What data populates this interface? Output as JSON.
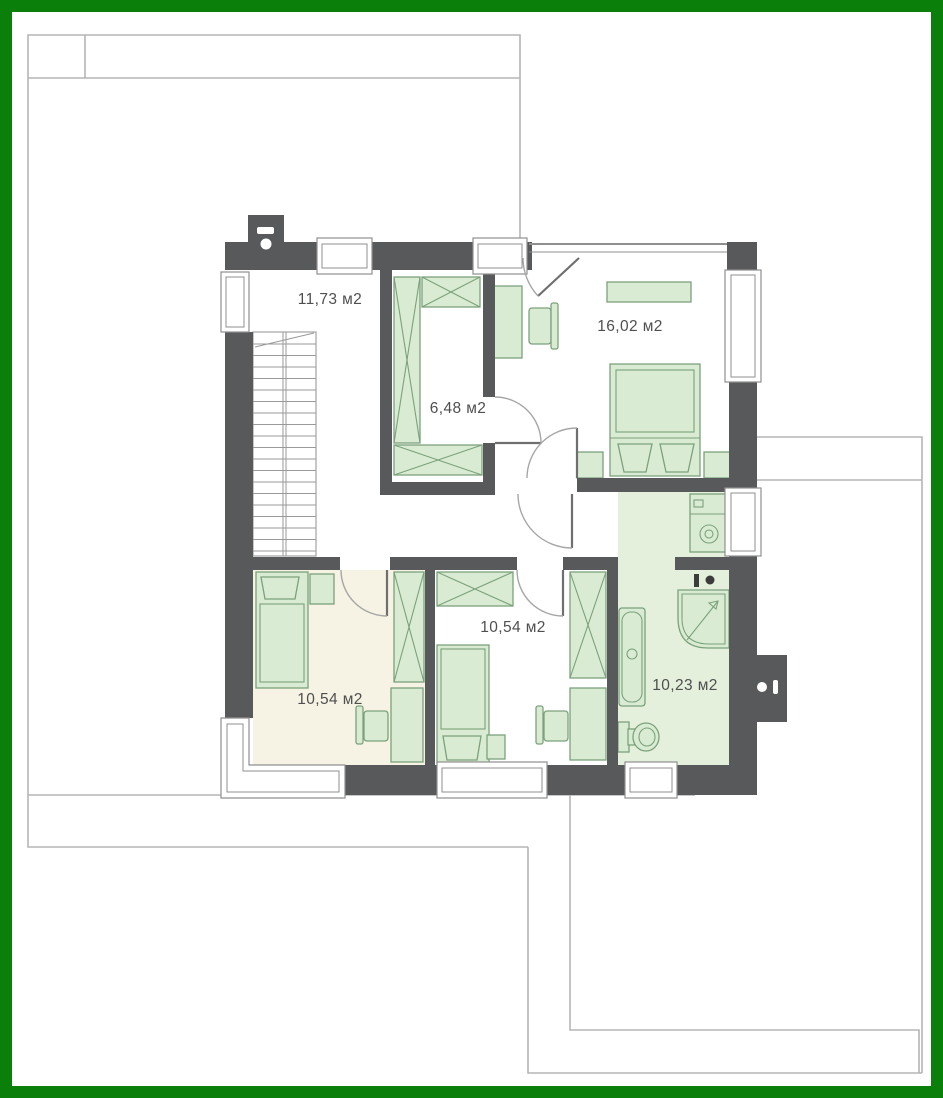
{
  "plan": {
    "colors": {
      "frame": "#0a800a",
      "wall": "#58595b",
      "furniture_fill": "#d9ecd3",
      "furniture_stroke": "#7ba17b",
      "bathroom_floor": "#e4f0dc",
      "left_room_floor": "#f6f3e4",
      "roof_outline": "#b5b5b5",
      "label_text": "#4f4f4f"
    },
    "rooms": [
      {
        "id": "stair-hall",
        "area": "11,73 м2"
      },
      {
        "id": "bedroom-main",
        "area": "16,02 м2"
      },
      {
        "id": "walk-in-closet",
        "area": "6,48 м2"
      },
      {
        "id": "bedroom-middle",
        "area": "10,54 м2"
      },
      {
        "id": "bedroom-left",
        "area": "10,54 м2"
      },
      {
        "id": "bathroom",
        "area": "10,23 м2"
      }
    ]
  }
}
